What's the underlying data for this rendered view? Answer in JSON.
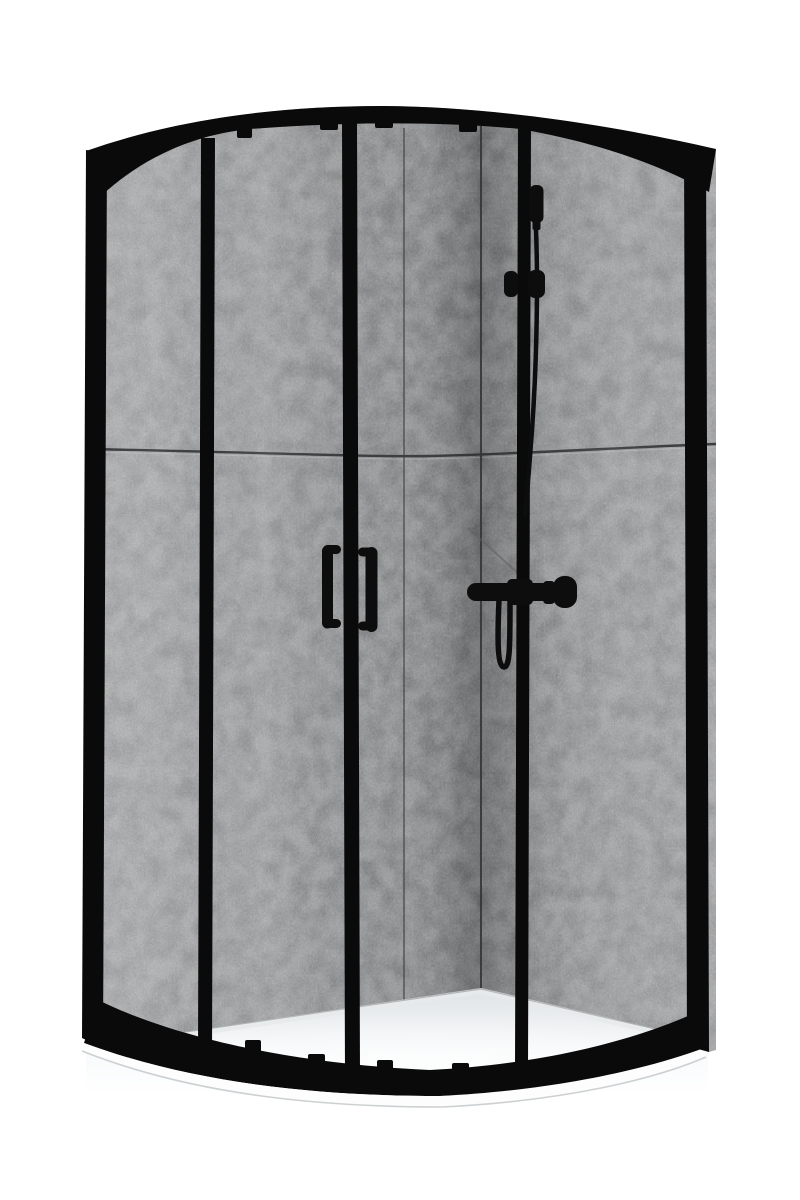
{
  "meta": {
    "description": "Product photograph on a white background: a quadrant corner shower enclosure with a matte black frame, curved top and bottom rails, two sliding glass doors with vertical black handles, concrete-look grey back wall panels, a black hand-shower set with rail and mixer on the right wall, and a low white quadrant shower tray."
  },
  "palette": {
    "background": "#ffffff",
    "frame_black": "#0a0a0a",
    "hardware_black": "#0d0d0d",
    "wall_light": "#a4a5a7",
    "wall_mid": "#909294",
    "wall_dark": "#6f7173",
    "seam_dark": "#3d3e40",
    "tray_back": "#dde1e3",
    "tray_front": "#f8fafb",
    "lip_white": "#fdfdfd",
    "lip_edge": "#cdd0d2"
  },
  "parts": {
    "enclosure": "Quadrant shower enclosure, black frame",
    "back_walls": "Concrete-look back wall panels",
    "left_wall": "Left back wall",
    "corner_wall": "Shadowed wall corner strip",
    "right_wall": "Right back wall",
    "wall_seam_horizontal": "Horizontal wall panel seam",
    "wall_seam_vertical": "Vertical wall panel seam",
    "corner_seam": "Wall corner joint",
    "tray": "Low white quadrant shower tray",
    "tray_lip": "Tray front rim",
    "top_rail": "Curved black top rail",
    "bottom_rail": "Curved black bottom rail",
    "left_upright": "Left wall profile",
    "left_divider": "Left fixed-panel divider",
    "center_stiles": "Central sliding-door stile",
    "right_divider": "Right fixed-panel divider",
    "right_upright": "Right wall profile",
    "roller_guides_top": "Door roller guides (top rail)",
    "roller_guides_bottom": "Door guide blocks (bottom rail)",
    "door_handle_left": "Left door handle",
    "door_handle_right": "Right door handle",
    "hand_shower": "Black hand shower handset",
    "rail_slider": "Shower rail slider holder",
    "shower_hose": "Shower hose",
    "mixer": "Black shower mixer with knob"
  }
}
